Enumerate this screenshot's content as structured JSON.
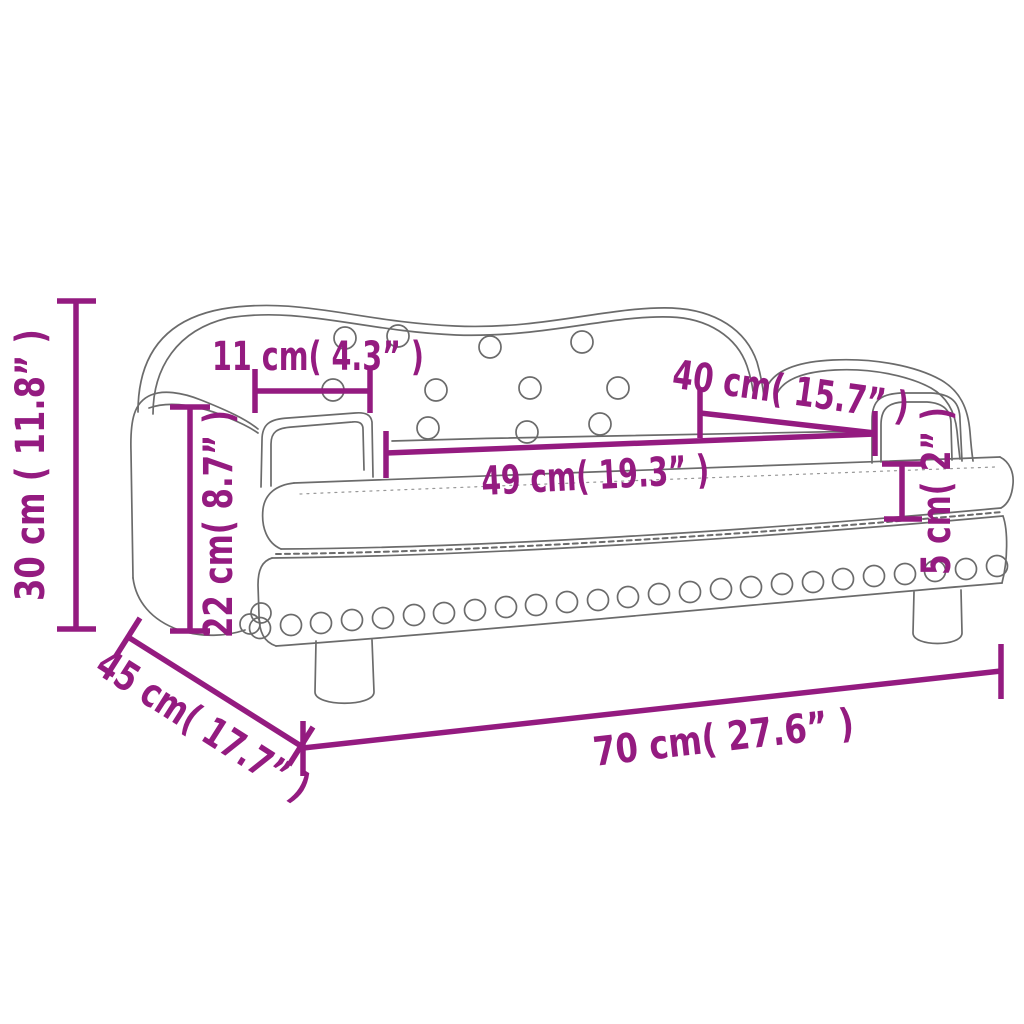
{
  "page": {
    "background": "#ffffff"
  },
  "diagram": {
    "kind": "product-dimension-diagram",
    "subject": "kids-sofa-line-drawing",
    "accent_color": "#941b80",
    "outline_color": "#6b6b6b",
    "dims": {
      "overall_height": {
        "label": "30 cm ( 11.8” )"
      },
      "armrest_height": {
        "label": "22 cm( 8.7” )"
      },
      "armrest_top_width": {
        "label": "11 cm( 4.3” )"
      },
      "back_to_armrest": {
        "label": "40 cm( 15.7” )"
      },
      "seat_width": {
        "label": "49 cm( 19.3” )"
      },
      "cushion_height": {
        "label": "5 cm( 2” )"
      },
      "overall_depth": {
        "label": "45 cm( 17.7” )"
      },
      "overall_width": {
        "label": "70 cm( 27.6” )"
      }
    }
  }
}
